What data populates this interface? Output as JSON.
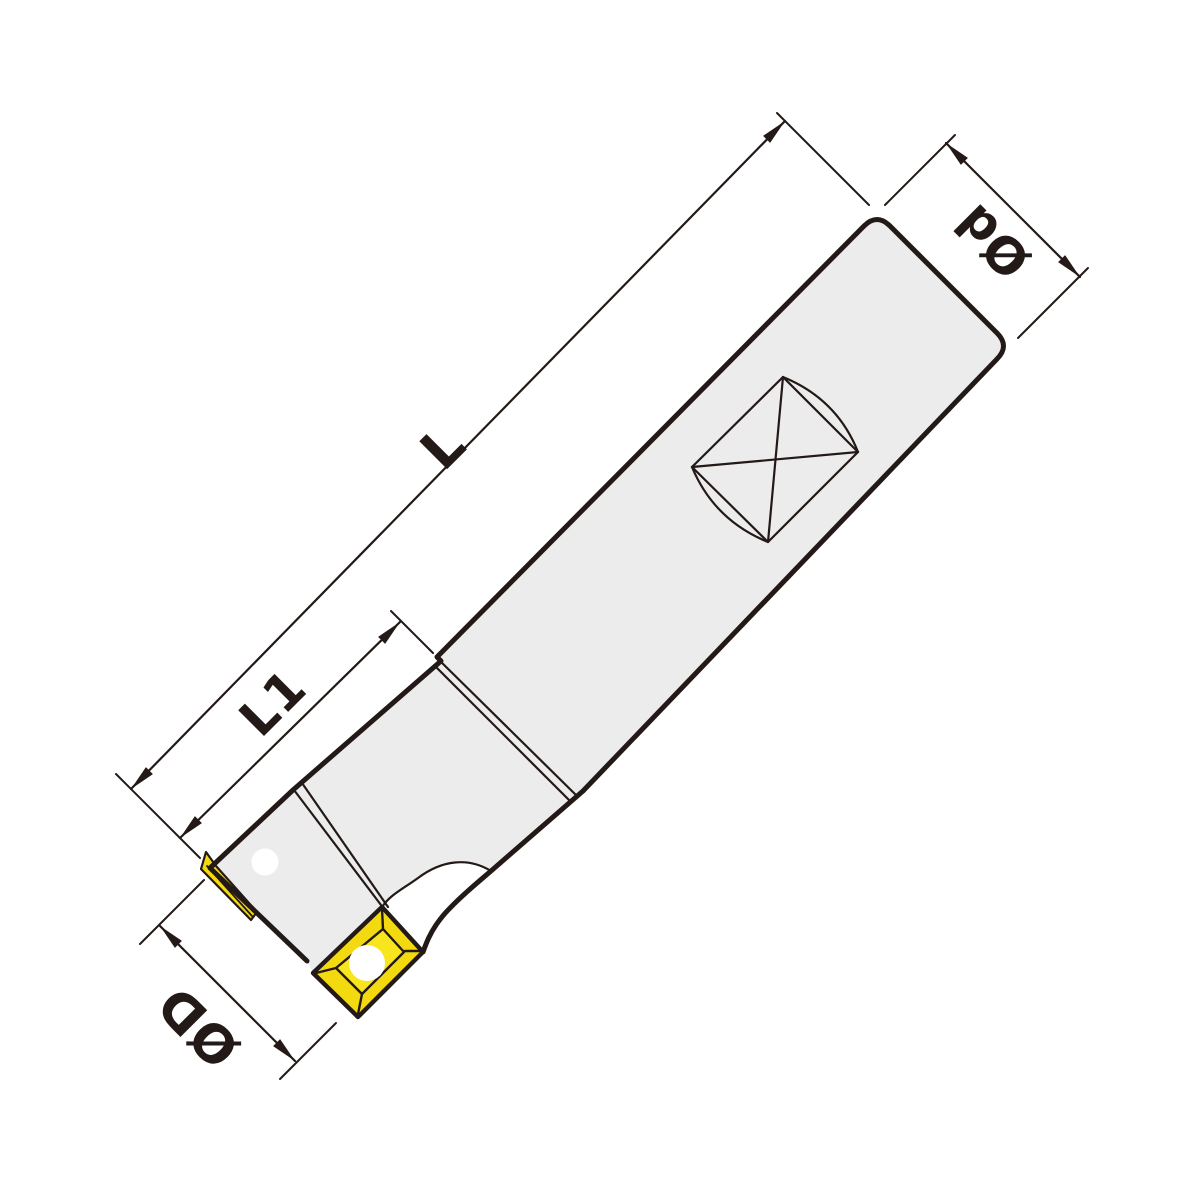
{
  "colors": {
    "line": "#231916",
    "body_fill": "#ececec",
    "insert_yellow": "#f3da10",
    "insert_face": "#f8e51e",
    "background": "#ffffff"
  },
  "drawing": {
    "subject": "indexable end mill with screw-clamped inserts",
    "labels": {
      "overall_length": "L",
      "head_length": "L1",
      "shank_diameter": "Ød",
      "cutting_diameter": "ØD"
    },
    "icons": {
      "screw": "torx-screw-icon",
      "flat": "square-flat-symbol",
      "hole": "pin-hole"
    }
  }
}
